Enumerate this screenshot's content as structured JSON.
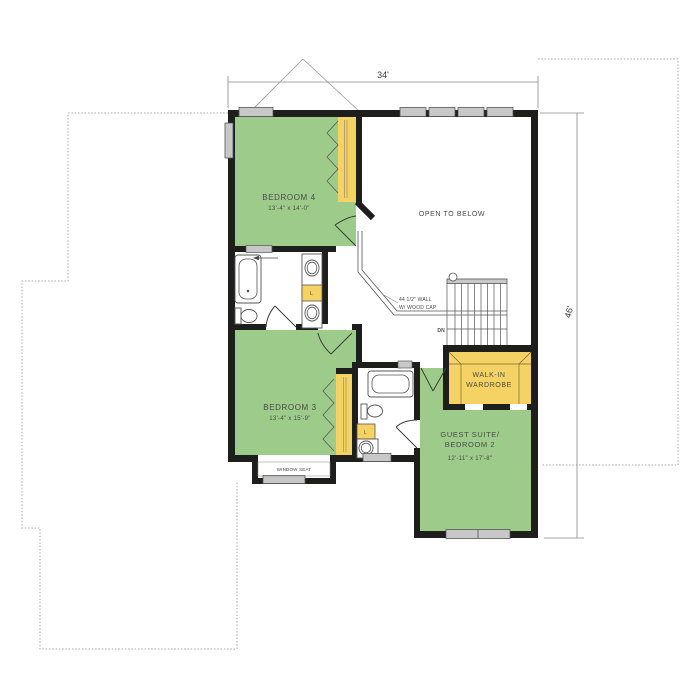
{
  "plan": {
    "dimensions": {
      "width": "34'",
      "height": "46'"
    },
    "rooms": {
      "bedroom4": {
        "name": "BEDROOM 4",
        "size": "13'-4\" x 14'-0\""
      },
      "bedroom3": {
        "name": "BEDROOM 3",
        "size": "13'-4\" x 15'-9\""
      },
      "guest_suite": {
        "name_line1": "GUEST SUITE/",
        "name_line2": "BEDROOM 2",
        "size": "12'-11\" x 17'-8\""
      },
      "walk_in_wardrobe": {
        "name_line1": "WALK-IN",
        "name_line2": "WARDROBE"
      },
      "open_to_below": {
        "name": "OPEN TO BELOW"
      },
      "window_seat": {
        "name": "WINDOW SEAT"
      }
    },
    "annotations": {
      "half_wall_line1": "44 1/2\" WALL",
      "half_wall_line2": "W/ WOOD CAP",
      "stairs_down": "DN",
      "linen_closet": "L"
    },
    "colors": {
      "room_green": "#9DCB8A",
      "closet_yellow": "#F5D264",
      "wall_black": "#1E1E1C",
      "window_gray": "#C8C8C8",
      "outline_gray": "#A8A8A8"
    }
  }
}
